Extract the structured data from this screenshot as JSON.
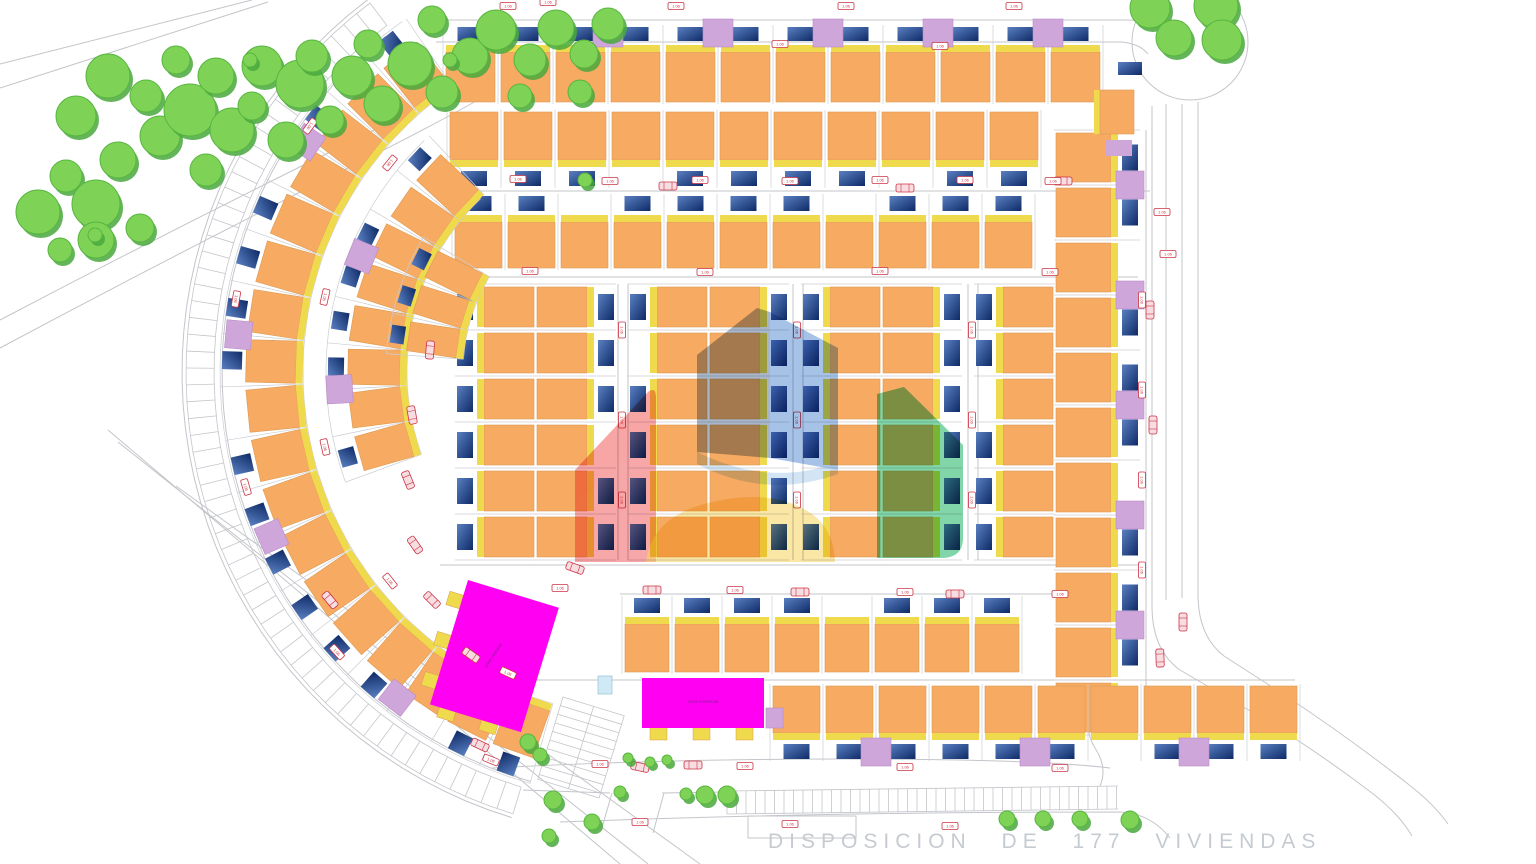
{
  "meta": {
    "caption": "DISPOSICION DE 177 VIVIENDAS"
  },
  "buildings_labels": {
    "magenta_left": "zona comunal",
    "magenta_right": "zona comercial"
  },
  "plot_label_text": "1.06",
  "colors": {
    "orange": "#F6AA62",
    "orangeStroke": "#DD9A52",
    "yellow": "#EFD94C",
    "purple": "#CFA6D9",
    "purpleStroke": "#B98CC6",
    "magenta": "#FF00F2",
    "magentaText": "#8A1E96",
    "carA": "#5A80C2",
    "carB": "#0E2A66",
    "road": "#C3C5CA",
    "faint": "#D9DADE",
    "cell": "#CBCDD3",
    "red": "#CC3344",
    "redFill": "#F7DDE2",
    "treeFill": "#7ED357",
    "treeEdge": "#57B53F",
    "treeShadow": "#49A83D",
    "pool": "#CFE9F5",
    "poolStroke": "#97BFD4",
    "caption": "#C6CBD1",
    "wmRed": "#F15E5E",
    "wmRedLight": "#F8A3A3",
    "wmBlueGray": "#6F86A4",
    "wmBlue": "#5E90D4",
    "wmLightBlue": "#A8CBEA",
    "wmGreen": "#2DB96E",
    "wmYellow": "#F7D76A"
  },
  "center": {
    "cx": 648,
    "cy": 372
  },
  "roads": [
    "M436,20 L1127,20",
    "M436,42 L1122,42",
    "M1127,20 Q1152,20 1163,32",
    "M1122,42 Q1140,44 1148,54",
    "M1152,106 L1152,606 Q1152,650 1180,670 L1252,712 Q1310,746 1368,790 Q1398,812 1412,836",
    "M1166,104 L1166,600",
    "M1182,104 L1182,598",
    "M1198,102 L1198,594 Q1198,636 1224,656 L1286,696 Q1352,740 1408,784 Q1434,804 1448,824",
    "M492,768 Q720,756 960,760 Q1060,762 1110,768",
    "M523,790 L610,793",
    "M662,793 L727,792",
    "M612,793 L601,831",
    "M664,793 L653,833",
    "M560,822 Q820,812 1120,812 Q1150,813 1170,838",
    "M1100,700 Q1080,724 1095,748 Q1108,768 1100,786",
    "M0,64 L252,0",
    "M0,88 L268,2",
    "M0,320 Q160,236 330,152 Q420,108 478,76",
    "M0,348 Q180,252 352,166 Q440,122 492,92",
    "M108,430 L620,864",
    "M118,442 L648,864",
    "M176,486 L700,864",
    "M452,191 L1150,191",
    "M452,277 L1138,277",
    "M440,565 L1140,565",
    "M620,594 L1100,594",
    "M480,680 L1295,680",
    "M618,284 L618,560",
    "M628,284 L628,560",
    "M793,284 L793,560",
    "M803,284 L803,560",
    "M968,284 L968,560",
    "M978,284 L978,560",
    "M1146,130 L1146,738"
  ],
  "roundabout": {
    "cx": 1190,
    "cy": 42,
    "r": 58
  },
  "layby": {
    "x": 748,
    "y": 816,
    "w": 108,
    "h": 22
  },
  "arcBand": {
    "r1": 434,
    "r2": 462,
    "a0": 107,
    "a1": 233,
    "step": 2.1
  },
  "arcEdges": [
    {
      "r": 426,
      "a0": 106,
      "a1": 234
    },
    {
      "r": 466,
      "a0": 107,
      "a1": 233
    }
  ],
  "bottomBand": {
    "x1": 727,
    "x2": 1118,
    "y1": 791,
    "y2": 786,
    "h": 23,
    "step": 9.5
  },
  "ladder": {
    "x": 563,
    "y": 697,
    "rot": 17,
    "w": 64,
    "h": 86,
    "step": 9
  },
  "groups": [
    {
      "kind": "row",
      "front": "start",
      "x": 443,
      "y": 27,
      "n": 12,
      "ux": 55,
      "body": 50,
      "strip": 7,
      "carW": 26,
      "carH": 14,
      "purple": [
        1,
        3,
        5,
        7,
        9,
        11
      ],
      "skipCar": []
    },
    {
      "kind": "row",
      "front": "end",
      "x": 447,
      "y": 112,
      "n": 11,
      "ux": 54,
      "body": 48,
      "strip": 7,
      "carW": 26,
      "carH": 15,
      "purple": [],
      "skipCar": [
        3,
        8
      ]
    },
    {
      "kind": "row",
      "front": "start",
      "x": 452,
      "y": 196,
      "n": 11,
      "ux": 53,
      "body": 46,
      "strip": 7,
      "carW": 26,
      "carH": 15,
      "purple": [],
      "skipCar": [
        2,
        7
      ]
    },
    {
      "kind": "col",
      "front": "start",
      "x": 457,
      "y": 284,
      "n": 6,
      "ux": 46,
      "body": 50,
      "strip": 7,
      "carW": 16,
      "carH": 26,
      "purple": [],
      "skipCar": []
    },
    {
      "kind": "col",
      "front": "end",
      "x": 537,
      "y": 284,
      "n": 6,
      "ux": 46,
      "body": 50,
      "strip": 7,
      "carW": 16,
      "carH": 26,
      "purple": [],
      "skipCar": [
        3
      ]
    },
    {
      "kind": "col",
      "front": "start",
      "x": 630,
      "y": 284,
      "n": 6,
      "ux": 46,
      "body": 50,
      "strip": 7,
      "carW": 16,
      "carH": 26,
      "purple": [],
      "skipCar": [
        1
      ]
    },
    {
      "kind": "col",
      "front": "end",
      "x": 710,
      "y": 284,
      "n": 6,
      "ux": 46,
      "body": 50,
      "strip": 7,
      "carW": 16,
      "carH": 26,
      "purple": [],
      "skipCar": []
    },
    {
      "kind": "col",
      "front": "start",
      "x": 803,
      "y": 284,
      "n": 6,
      "ux": 46,
      "body": 50,
      "strip": 7,
      "carW": 16,
      "carH": 26,
      "purple": [],
      "skipCar": [
        4
      ]
    },
    {
      "kind": "col",
      "front": "end",
      "x": 883,
      "y": 284,
      "n": 6,
      "ux": 46,
      "body": 50,
      "strip": 7,
      "carW": 16,
      "carH": 26,
      "purple": [],
      "skipCar": []
    },
    {
      "kind": "col",
      "front": "start",
      "x": 976,
      "y": 284,
      "n": 6,
      "ux": 46,
      "body": 50,
      "strip": 7,
      "carW": 16,
      "carH": 26,
      "purple": [],
      "skipCar": [
        2
      ]
    },
    {
      "kind": "col",
      "front": "end",
      "x": 1056,
      "y": 130,
      "n": 11,
      "ux": 55,
      "body": 55,
      "strip": 7,
      "carW": 16,
      "carH": 26,
      "purple": [
        1,
        3,
        5,
        7,
        9
      ],
      "skipCar": [
        2,
        6
      ]
    },
    {
      "kind": "row",
      "front": "start",
      "x": 622,
      "y": 598,
      "n": 8,
      "ux": 50,
      "body": 48,
      "strip": 7,
      "carW": 26,
      "carH": 15,
      "purple": [],
      "skipCar": [
        4
      ]
    },
    {
      "kind": "row",
      "front": "end",
      "x": 770,
      "y": 686,
      "n": 10,
      "ux": 53,
      "body": 47,
      "strip": 7,
      "carW": 26,
      "carH": 15,
      "purple": [
        2,
        5,
        8
      ],
      "skipCar": [
        6
      ]
    }
  ],
  "arcRows": [
    {
      "r1": 352,
      "r2": 402,
      "strip": 7,
      "carL": 20,
      "a0": 106,
      "step": 7.2,
      "n": 18,
      "purple": [
        3,
        7,
        11,
        15
      ],
      "skipCar": [
        2,
        9,
        14
      ]
    },
    {
      "r1": 248,
      "r2": 300,
      "strip": 7,
      "carL": 16,
      "a0": 160,
      "step": 8.4,
      "n": 8,
      "purple": [
        2,
        5
      ],
      "skipCar": [
        1,
        6
      ]
    },
    {
      "r1": 192,
      "r2": 242,
      "strip": 7,
      "carL": 14,
      "a0": 184,
      "step": 9.0,
      "n": 3,
      "purple": [],
      "skipCar": []
    }
  ],
  "magenta": [
    {
      "x": 468,
      "y": 580,
      "w": 95,
      "h": 130,
      "rot": 17,
      "labelKey": "magenta_left",
      "labelRot": -73,
      "tabs": [
        [
          -14,
          16
        ],
        [
          -14,
          58
        ],
        [
          -14,
          100
        ],
        [
          10,
          126
        ],
        [
          54,
          126
        ]
      ]
    },
    {
      "x": 642,
      "y": 678,
      "w": 122,
      "h": 50,
      "rot": 0,
      "labelKey": "magenta_right",
      "labelRot": 0,
      "tabs": [
        [
          8,
          48
        ],
        [
          51,
          48
        ],
        [
          94,
          48
        ]
      ]
    }
  ],
  "lilacTab": {
    "x": 766,
    "y": 708,
    "w": 17,
    "h": 20
  },
  "pool": {
    "x": 598,
    "y": 676,
    "w": 14,
    "h": 18
  },
  "extras": [
    {
      "x": 1094,
      "y": 90,
      "w": 6,
      "h": 44,
      "f": "yellow"
    },
    {
      "x": 1100,
      "y": 90,
      "w": 34,
      "h": 44,
      "f": "orange"
    },
    {
      "x": 1106,
      "y": 140,
      "w": 26,
      "h": 16,
      "f": "purple"
    },
    {
      "x": 1118,
      "y": 62,
      "w": 24,
      "h": 13,
      "f": "car"
    }
  ],
  "trees": [
    [
      38,
      212,
      22
    ],
    [
      66,
      176,
      16
    ],
    [
      96,
      204,
      24
    ],
    [
      118,
      160,
      18
    ],
    [
      76,
      116,
      20
    ],
    [
      108,
      76,
      22
    ],
    [
      146,
      96,
      16
    ],
    [
      160,
      136,
      20
    ],
    [
      190,
      110,
      26
    ],
    [
      176,
      60,
      14
    ],
    [
      216,
      76,
      18
    ],
    [
      232,
      130,
      22
    ],
    [
      206,
      170,
      16
    ],
    [
      252,
      106,
      14
    ],
    [
      262,
      66,
      20
    ],
    [
      300,
      84,
      24
    ],
    [
      286,
      140,
      18
    ],
    [
      330,
      120,
      14
    ],
    [
      312,
      56,
      16
    ],
    [
      352,
      76,
      20
    ],
    [
      382,
      104,
      18
    ],
    [
      368,
      44,
      14
    ],
    [
      410,
      64,
      22
    ],
    [
      442,
      92,
      16
    ],
    [
      470,
      56,
      18
    ],
    [
      432,
      20,
      14
    ],
    [
      496,
      30,
      20
    ],
    [
      530,
      60,
      16
    ],
    [
      556,
      28,
      18
    ],
    [
      584,
      54,
      14
    ],
    [
      608,
      24,
      16
    ],
    [
      520,
      96,
      12
    ],
    [
      580,
      92,
      12
    ],
    [
      96,
      240,
      18
    ],
    [
      140,
      228,
      14
    ],
    [
      60,
      250,
      12
    ],
    [
      250,
      60,
      7
    ],
    [
      450,
      60,
      7
    ],
    [
      585,
      180,
      7
    ],
    [
      95,
      235,
      7
    ],
    [
      1150,
      8,
      20
    ],
    [
      1216,
      6,
      22
    ],
    [
      1174,
      38,
      18
    ],
    [
      1222,
      40,
      20
    ]
  ],
  "bushes": [
    [
      528,
      742,
      8
    ],
    [
      540,
      755,
      7
    ],
    [
      553,
      800,
      9
    ],
    [
      592,
      822,
      8
    ],
    [
      620,
      792,
      6
    ],
    [
      628,
      758,
      5
    ],
    [
      650,
      762,
      5
    ],
    [
      705,
      795,
      9
    ],
    [
      727,
      795,
      9
    ],
    [
      1007,
      819,
      8
    ],
    [
      1043,
      819,
      8
    ],
    [
      1080,
      819,
      8
    ],
    [
      1130,
      820,
      9
    ],
    [
      549,
      836,
      7
    ],
    [
      667,
      760,
      5
    ],
    [
      686,
      794,
      6
    ]
  ],
  "redCars": [
    [
      1063,
      181,
      0
    ],
    [
      1150,
      310,
      90
    ],
    [
      1153,
      425,
      90
    ],
    [
      1183,
      622,
      90
    ],
    [
      1160,
      658,
      88
    ],
    [
      575,
      568,
      20
    ],
    [
      652,
      590,
      0
    ],
    [
      800,
      592,
      0
    ],
    [
      955,
      594,
      0
    ],
    [
      693,
      765,
      0
    ],
    [
      640,
      767,
      12
    ],
    [
      471,
      655,
      35
    ],
    [
      432,
      600,
      45
    ],
    [
      415,
      545,
      55
    ],
    [
      408,
      480,
      68
    ],
    [
      412,
      415,
      80
    ],
    [
      430,
      350,
      95
    ],
    [
      480,
      745,
      25
    ],
    [
      330,
      600,
      50
    ],
    [
      668,
      186,
      0
    ],
    [
      905,
      188,
      0
    ]
  ],
  "plotLabels": [
    [
      508,
      6,
      0
    ],
    [
      676,
      6,
      0
    ],
    [
      846,
      6,
      0
    ],
    [
      1014,
      6,
      0
    ],
    [
      518,
      179,
      0
    ],
    [
      610,
      181,
      0
    ],
    [
      700,
      180,
      0
    ],
    [
      790,
      181,
      0
    ],
    [
      880,
      180,
      0
    ],
    [
      965,
      180,
      0
    ],
    [
      1053,
      181,
      0
    ],
    [
      530,
      271,
      0
    ],
    [
      705,
      272,
      0
    ],
    [
      880,
      271,
      0
    ],
    [
      1050,
      272,
      0
    ],
    [
      622,
      330,
      90
    ],
    [
      622,
      420,
      90
    ],
    [
      622,
      500,
      90
    ],
    [
      797,
      330,
      90
    ],
    [
      797,
      420,
      90
    ],
    [
      797,
      500,
      90
    ],
    [
      972,
      330,
      90
    ],
    [
      972,
      420,
      90
    ],
    [
      972,
      500,
      90
    ],
    [
      1142,
      300,
      90
    ],
    [
      1142,
      390,
      90
    ],
    [
      1142,
      480,
      90
    ],
    [
      1142,
      570,
      90
    ],
    [
      1162,
      212,
      0
    ],
    [
      1168,
      254,
      0
    ],
    [
      560,
      588,
      0
    ],
    [
      735,
      590,
      0
    ],
    [
      905,
      592,
      0
    ],
    [
      1060,
      594,
      0
    ],
    [
      600,
      764,
      0
    ],
    [
      745,
      766,
      0
    ],
    [
      905,
      767,
      0
    ],
    [
      1060,
      768,
      0
    ],
    [
      640,
      822,
      0
    ],
    [
      790,
      824,
      0
    ],
    [
      950,
      826,
      0
    ],
    [
      508,
      673,
      25
    ],
    [
      390,
      581,
      51
    ],
    [
      325,
      447,
      77
    ],
    [
      325,
      297,
      103
    ],
    [
      390,
      163,
      129
    ],
    [
      491,
      760,
      22
    ],
    [
      337,
      652,
      48
    ],
    [
      246,
      487,
      74
    ],
    [
      236,
      299,
      100
    ],
    [
      310,
      126,
      126
    ],
    [
      548,
      2,
      0
    ],
    [
      780,
      44,
      0
    ],
    [
      940,
      46,
      0
    ]
  ],
  "watermark": [
    {
      "d": "M575,562 L575,470 L648,392 Q656,386 656,398 L656,562 Z",
      "c": "wmRed",
      "o": 0.55
    },
    {
      "d": "M575,470 L648,392 L656,398 L656,430 L575,505 Z",
      "c": "wmRedLight",
      "o": 0.4
    },
    {
      "d": "M697,452 L697,355 L757,308 L770,312 L770,458 Z",
      "c": "wmBlueGray",
      "o": 0.6
    },
    {
      "d": "M770,312 L838,348 L838,470 L770,458 Z",
      "c": "wmBlue",
      "o": 0.55
    },
    {
      "d": "M697,452 Q770,488 838,462 L838,474 Q766,500 697,464 Z",
      "c": "wmLightBlue",
      "o": 0.5
    },
    {
      "d": "M877,558 L877,394 L904,387 L963,445 L963,538 Q963,558 941,558 Z",
      "c": "wmGreen",
      "o": 0.6
    },
    {
      "d": "M646,562 Q652,518 704,504 Q772,486 812,514 Q834,530 835,562 Z",
      "c": "wmYellow",
      "o": 0.6
    }
  ]
}
